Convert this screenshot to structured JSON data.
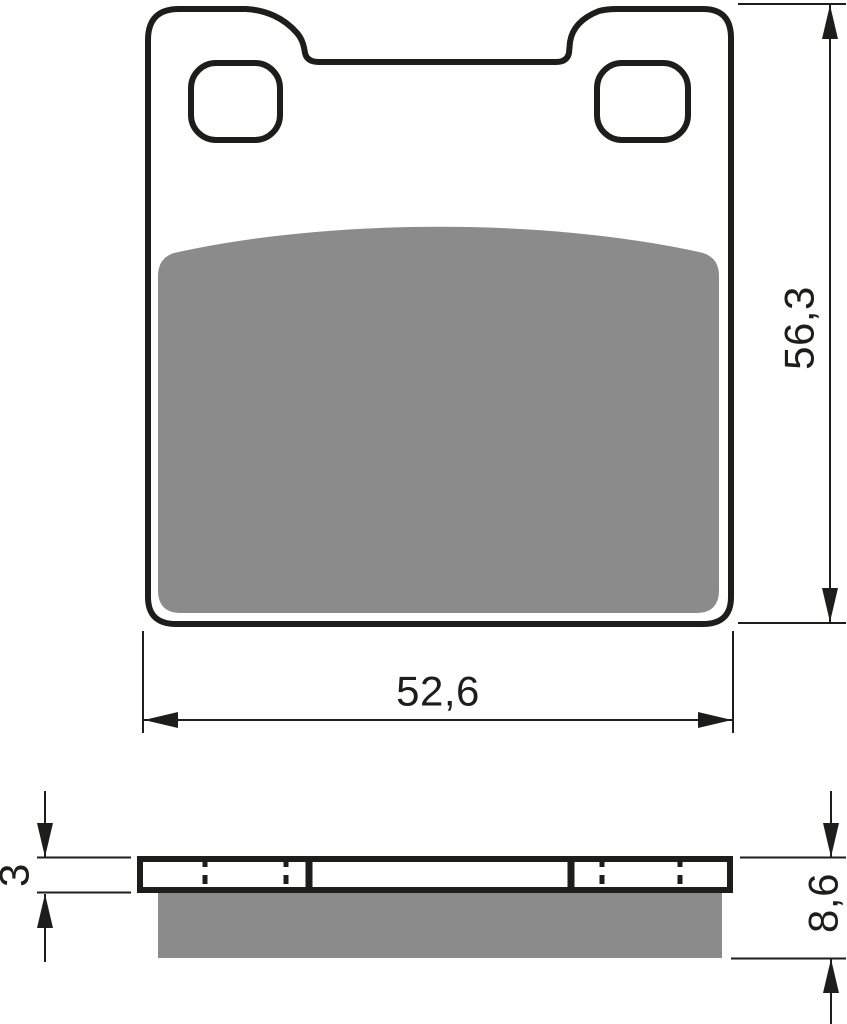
{
  "drawing": {
    "type": "technical-dimension-drawing",
    "subject": "brake-pad",
    "views": {
      "front_view": "pad outline with two rounded mounting holes, top center notch and friction material area",
      "side_view": "backing plate profile with hidden hole lines and friction material layer"
    }
  },
  "dimensions": {
    "height_label": "56,3",
    "width_label": "52,6",
    "backplate_thickness_label": "3",
    "overall_thickness_label": "8,6"
  },
  "colors": {
    "line": "#1d1d1b",
    "friction_material": "#8b8b8b",
    "background": "#ffffff"
  }
}
